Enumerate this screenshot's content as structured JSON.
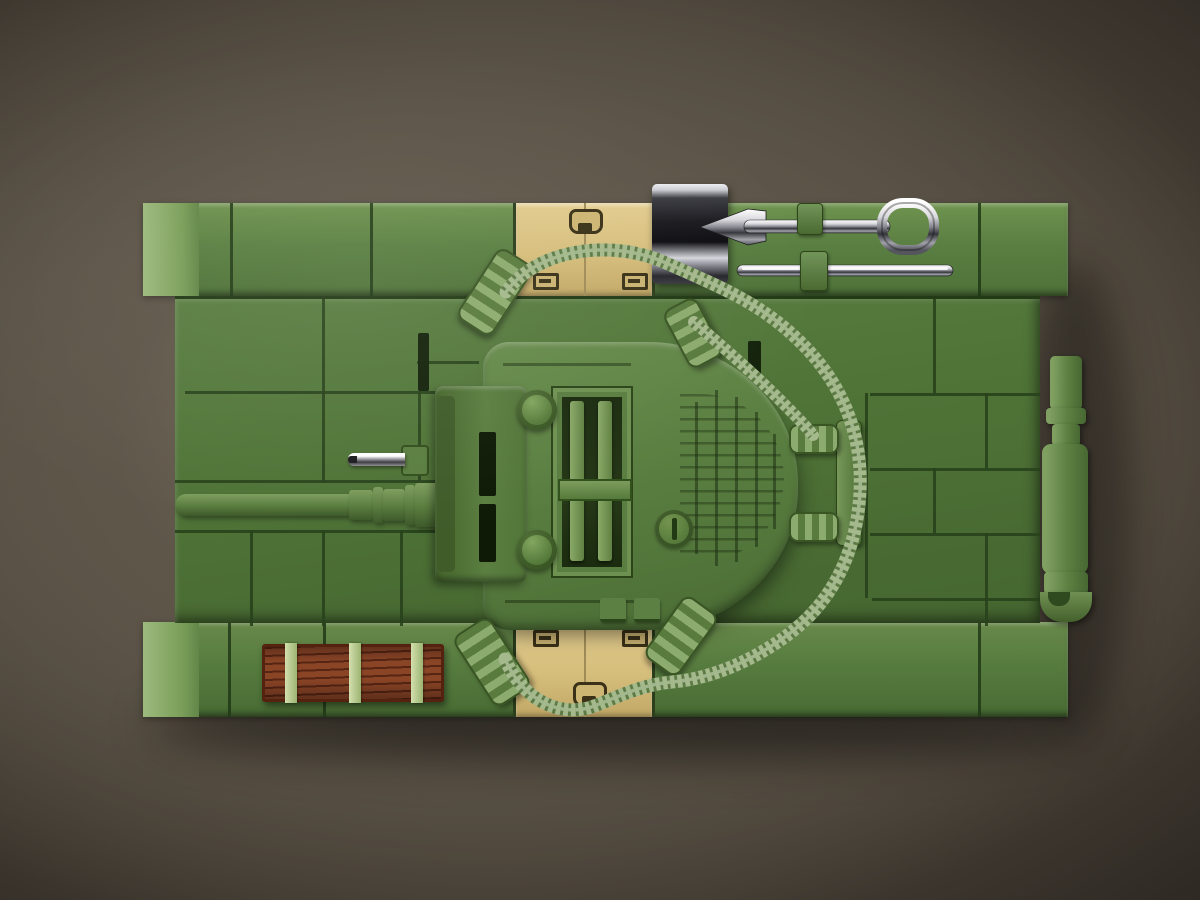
{
  "scene": {
    "type": "product-photo",
    "description": "Top-down studio photo of an olive-green interlocking-brick (COBI-style) model tank with gun facing left, on a dark brown vignetted backdrop",
    "canvas": {
      "width": 1200,
      "height": 900
    }
  },
  "background": {
    "label": "dark brown studio backdrop with vignette",
    "center_color": "#6d6356",
    "edge_color": "#141210"
  },
  "palette": {
    "brick_green": "#4f7337",
    "fender_green": "#5a7f42",
    "turret_green": "#597d40",
    "tan_panel": "#d5bd7b",
    "wood_brown": "#8a4426",
    "strap_green": "#b9ce97",
    "chrome": "#d8d8dc",
    "dark_chrome": "#1a1a1f",
    "hose_green": "#a4b98c",
    "seam_green": "#28431c"
  },
  "objects": {
    "hull": {
      "label": "brick-built tank hull, top view"
    },
    "fender_front": {
      "label": "front fender brick row"
    },
    "fender_rear": {
      "label": "rear fender brick row"
    },
    "tan_panel_front": {
      "label": "tan hatch panel with printed handle and two latches"
    },
    "tan_panel_rear": {
      "label": "tan hatch panel with printed handle and two latches"
    },
    "turret": {
      "label": "rounded turret with central hatch, slotted filler cap and mantlet"
    },
    "hatch": {
      "label": "central turret hatch with twin rails"
    },
    "mantlet": {
      "label": "gun mantlet block with two round hinge pegs"
    },
    "main_gun": {
      "label": "green main gun barrel pointing left with stepped base rings"
    },
    "machine_gun": {
      "label": "chrome hull machine gun above the main gun"
    },
    "shovel": {
      "label": "chrome shovel with D-handle stowed on front fender"
    },
    "rod": {
      "label": "chrome stowage rod below the shovel"
    },
    "chrome_box": {
      "label": "dark chrome stowage box on front fender"
    },
    "tool_clips": {
      "label": "green clips holding the chrome tools"
    },
    "hose_main": {
      "label": "long ribbed green hose looping around the right of the turret, elbow couplers at both ends"
    },
    "hose_short": {
      "label": "short ribbed hose from turret elbow to deck bracket coupler"
    },
    "hose_bracket": {
      "label": "deck bracket with two ribbed hose couplers"
    },
    "elbow_count": "4 green elbow connectors",
    "wood_plank": {
      "label": "brown wooden plank crate with three light-green straps"
    },
    "exhaust": {
      "label": "green exhaust / muffler assembly hooked on right hull side"
    }
  }
}
